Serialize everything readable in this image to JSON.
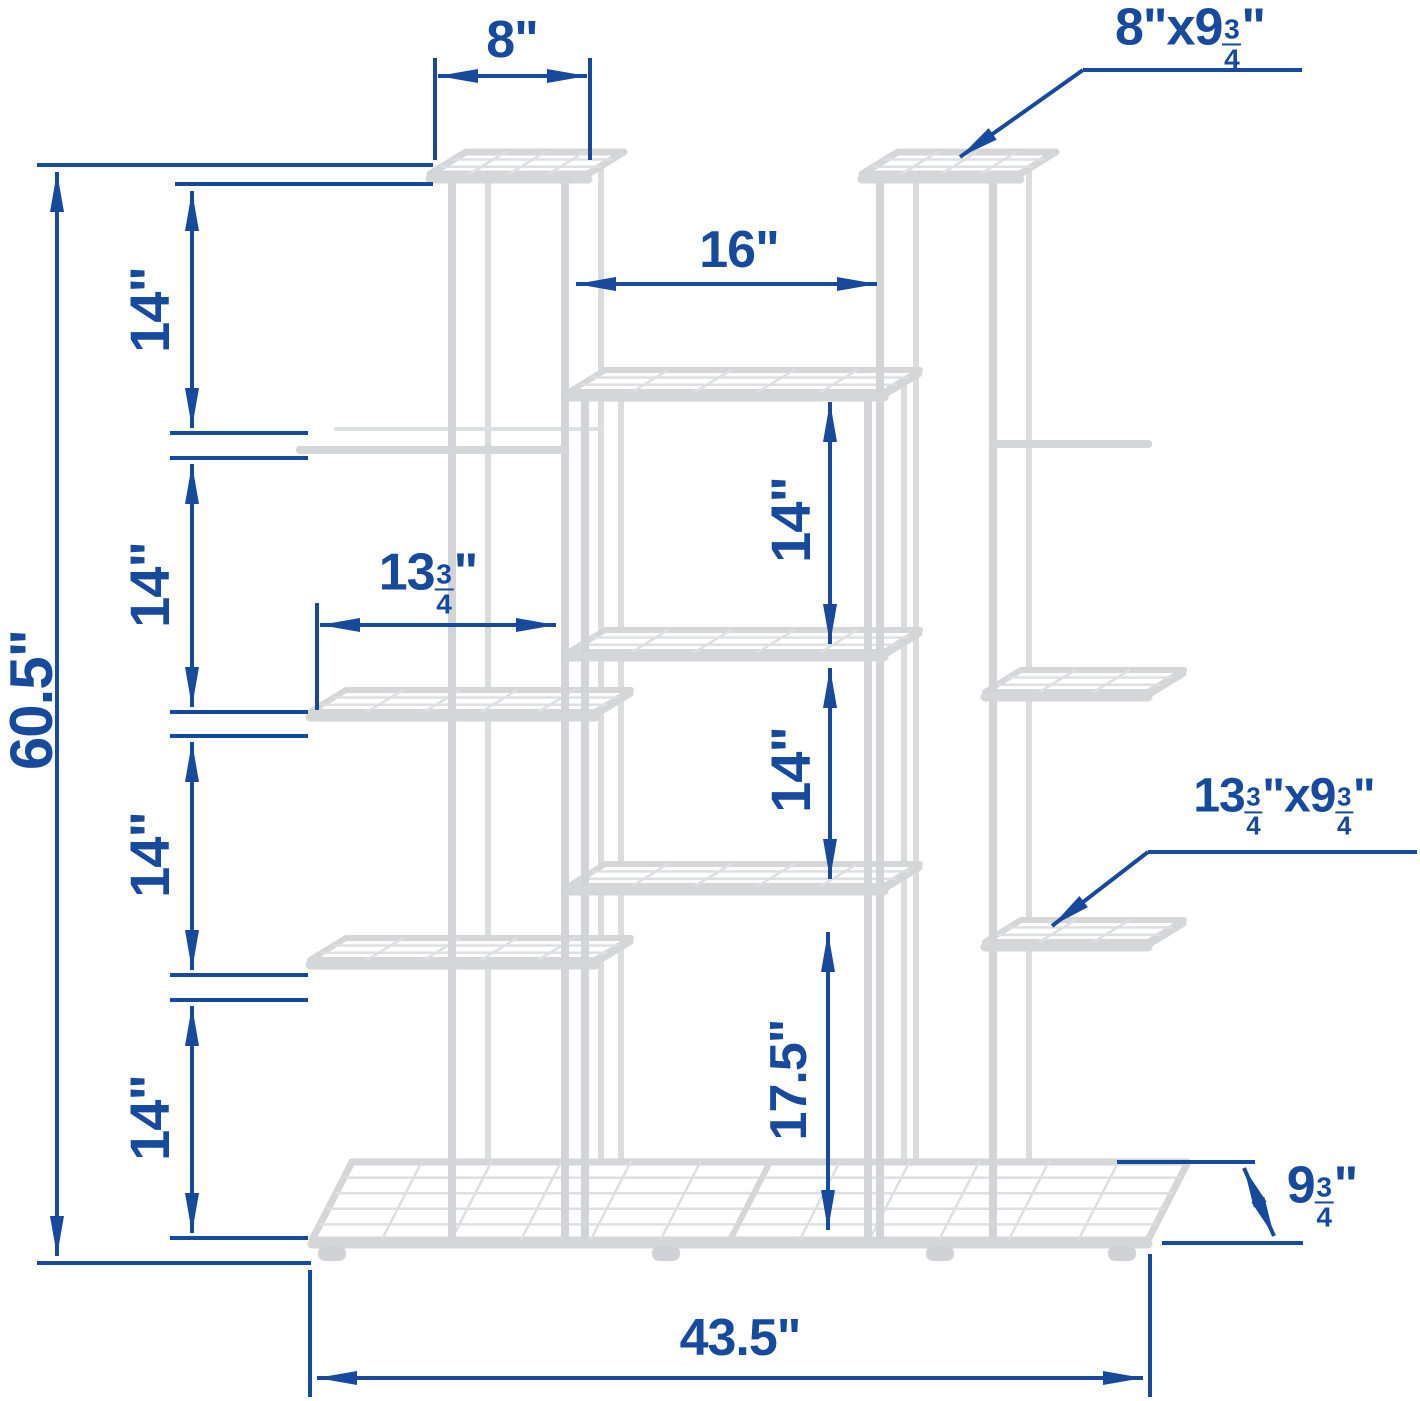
{
  "colors": {
    "dimension_blue": "#174a9c",
    "frame_gray": "#d4d6d8",
    "grid_gray": "#dde0e2",
    "background": "#ffffff"
  },
  "dims": {
    "top_width": "8\"",
    "top_shelf": {
      "pre": "8\"x9",
      "num": "3",
      "den": "4",
      "post": "\""
    },
    "gap": "16\"",
    "total_height": "60.5\"",
    "tiers": [
      "14\"",
      "14\"",
      "14\"",
      "14\""
    ],
    "mid_width": {
      "pre": "13",
      "num": "3",
      "den": "4",
      "post": "\""
    },
    "mid_gap_1": "14\"",
    "mid_gap_2": "14\"",
    "bottom_gap": "17.5\"",
    "side_shelf": {
      "pre": "13",
      "num": "3",
      "den": "4",
      "mid": "\"x9",
      "num2": "3",
      "den2": "4",
      "post": "\""
    },
    "depth": {
      "pre": "9",
      "num": "3",
      "den": "4",
      "post": "\""
    },
    "base_width": "43.5\""
  }
}
